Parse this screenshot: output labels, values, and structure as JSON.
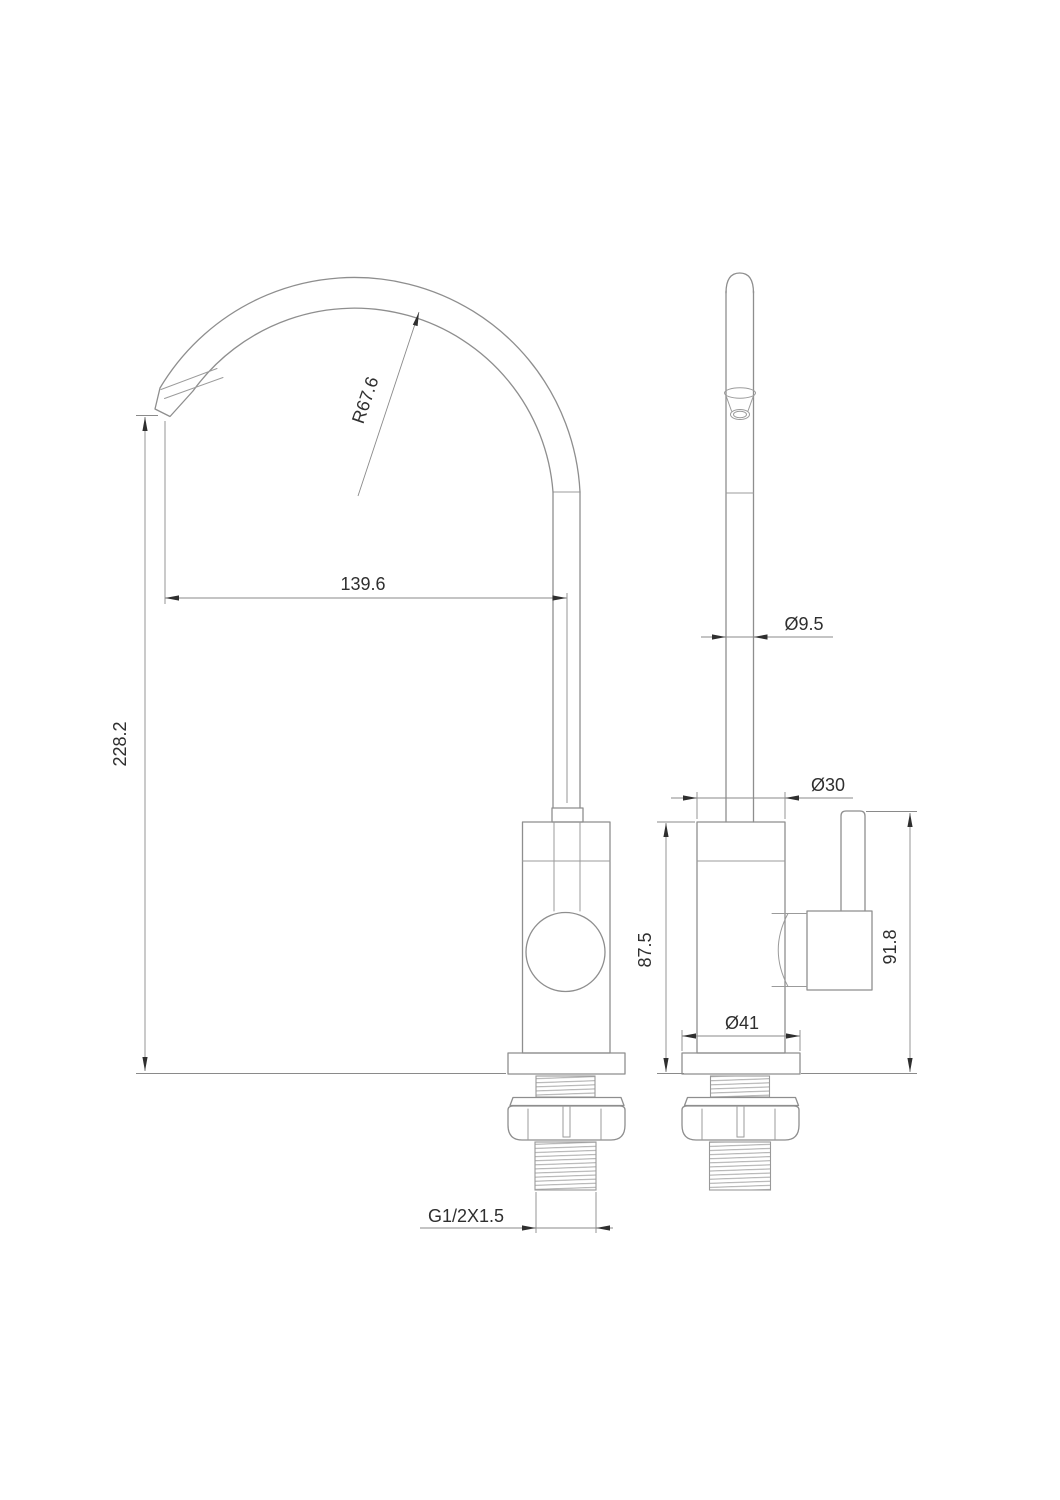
{
  "drawing": {
    "kind": "faucet-technical-drawing",
    "description": "Gooseneck drinking water faucet, dimensioned 2-view CAD drawing",
    "colors": {
      "background": "#ffffff",
      "part_line": "#8e8e8e",
      "dimension_line": "#8a8a8a",
      "text": "#2f2f2f"
    },
    "dimensions": {
      "spout_radius": "R67.6",
      "spout_reach": "139.6",
      "overall_height": "228.2",
      "spout_tube_diameter": "Ø9.5",
      "body_diameter": "Ø30",
      "body_height": "87.5",
      "base_diameter": "Ø41",
      "handle_height": "91.8",
      "thread_spec": "G1/2X1.5"
    }
  }
}
